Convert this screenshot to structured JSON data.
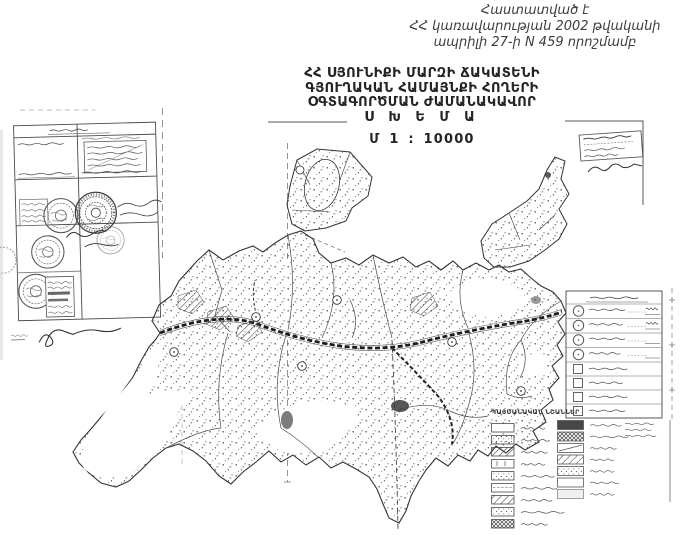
{
  "page": {
    "approval": {
      "line1": "Հաստատված է",
      "line2": "ՀՀ կառավարության 2002 թվականի",
      "line3": "ապրիլի 27-ի N 459 որոշմամբ"
    },
    "title": {
      "line1": "ՀՀ ՍՅՈՒՆԻՔԻ ՄԱՐԶԻ ՃԱԿԱՏԵՆԻ",
      "line2": "ԳՅՈՒՂԱԿԱՆ ՀԱՄԱՅՆՔԻ ՀՈՂԵՐԻ",
      "line3": "ՕԳՏԱԳՈՐԾՄԱՆ ԺԱՄԱՆԱԿԱՎՈՐ",
      "line4": "Ս Խ Ե Մ Ա"
    },
    "scale": "Մ 1 : 10000",
    "legend_title": "ՊԱՅՄԱՆԱԿԱՆ ՆՇԱՆՆԵՐ",
    "colors": {
      "paper": "#ffffff",
      "ink": "#242424",
      "map_line": "#3a3a3a",
      "faint_line": "#8a8a8a"
    }
  }
}
